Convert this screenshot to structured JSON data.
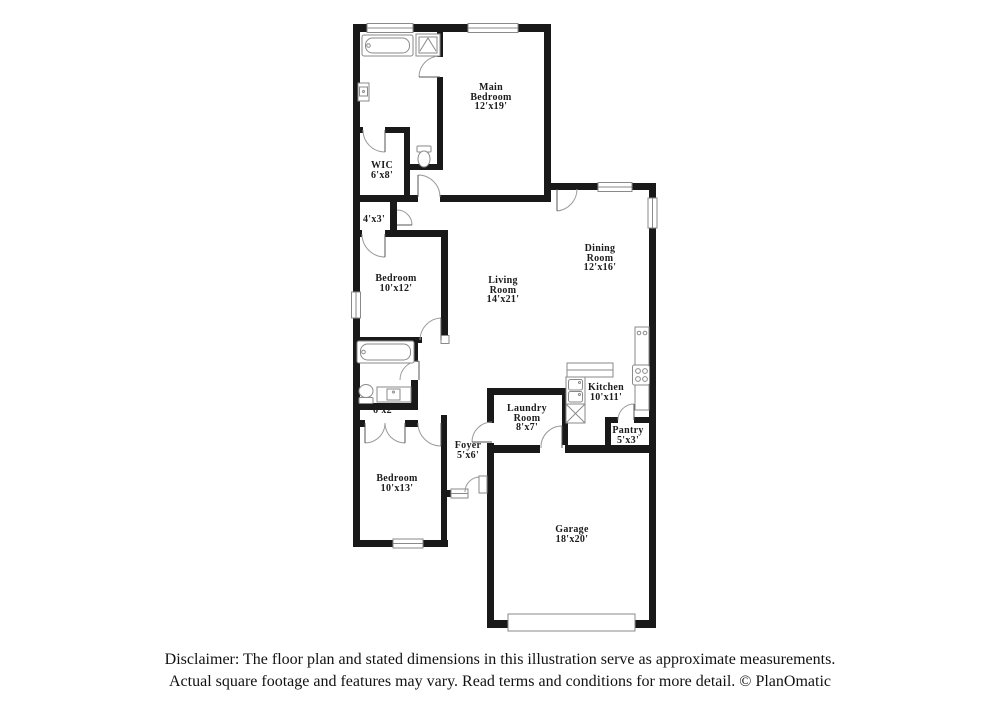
{
  "floor_plan": {
    "rooms": [
      {
        "name": "Main Bedroom",
        "dims": "12'x19'"
      },
      {
        "name": "WIC",
        "dims": "6'x8'"
      },
      {
        "dims": "4'x3'"
      },
      {
        "name": "Bedroom",
        "dims": "10'x12'"
      },
      {
        "name": "Living Room",
        "dims": "14'x21'"
      },
      {
        "name": "Dining Room",
        "dims": "12'x16'"
      },
      {
        "name": "Kitchen",
        "dims": "10'x11'"
      },
      {
        "name": "Laundry Room",
        "dims": "8'x7'"
      },
      {
        "name": "Pantry",
        "dims": "5'x3'"
      },
      {
        "name": "Foyer",
        "dims": "5'x6'"
      },
      {
        "dims": "6'x2'"
      },
      {
        "name": "Bedroom",
        "dims": "10'x13'"
      },
      {
        "name": "Garage",
        "dims": "18'x20'"
      }
    ],
    "fixture_icons": [
      "bathtub-icon",
      "shower-icon",
      "toilet-icon",
      "vanity-sink-icon",
      "kitchen-sink-icon",
      "dishwasher-icon",
      "cooktop-icon",
      "garage-door",
      "front-door",
      "window"
    ],
    "colors": {
      "wall": "#191919",
      "fixture_outline": "#8a8a8a",
      "door_arc": "#9a9a9a",
      "background": "#ffffff",
      "text": "#1c1c1c"
    }
  },
  "disclaimer": {
    "line1": "Disclaimer: The floor plan and stated dimensions in this illustration serve as approximate measurements.",
    "line2": "Actual square footage and features may vary. Read terms and conditions for more detail. © PlanOmatic"
  }
}
